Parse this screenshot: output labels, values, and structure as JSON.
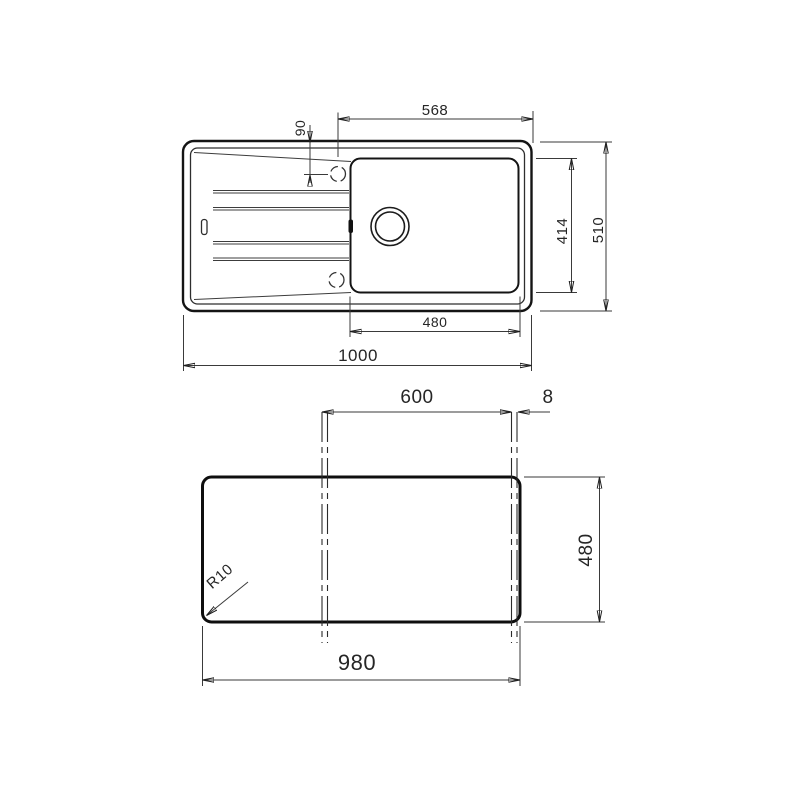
{
  "page": {
    "background": "#ffffff",
    "line_color": "#1c1c1c",
    "description": "Technical dimension drawing of an inset kitchen sink: plan view with bowl and drainer, plus worktop cutout template view"
  },
  "top_view": {
    "overall_width": "1000",
    "overall_depth": "510",
    "bowl_width": "480",
    "bowl_depth": "414",
    "tap_to_edge": "568",
    "tap_offset": "90"
  },
  "cutout_view": {
    "width": "980",
    "depth": "480",
    "centerline_span": "600",
    "edge_gap": "8",
    "corner_radius": "R10"
  }
}
